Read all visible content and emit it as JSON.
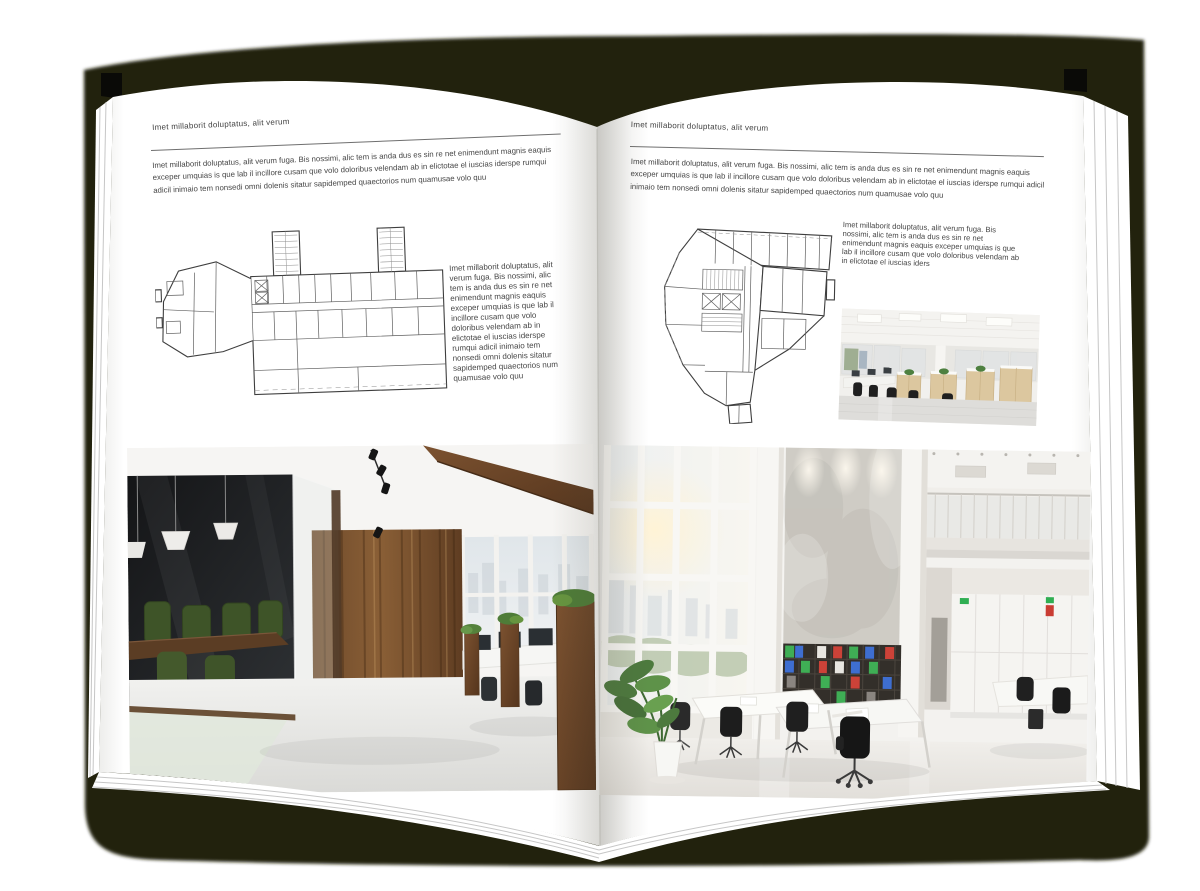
{
  "pages": {
    "left": {
      "header": "Imet millaborit doluptatus, alit verum",
      "intro": "Imet millaborit doluptatus, alit verum fuga. Bis nossimi, alic tem is anda dus es sin re net enimendunt magnis eaquis exceper umquias is que lab il incillore cusam que volo doloribus velendam ab in elictotae el iuscias iderspe rumqui adicil inimaio tem nonsedi omni dolenis sitatur sapidemped quaectorios num quamusae volo quu",
      "side_text": "Imet millaborit doluptatus, alit verum fuga. Bis nossimi, alic tem is anda dus es sin re net enimendunt magnis eaquis exceper umquias is que lab il incillore cusam que volo doloribus velendam ab in elictotae el iuscias iderspe rumqui adicil inimaio tem nonsedi omni dolenis sitatur sapidemped quaectorios num quamusae volo quu"
    },
    "right": {
      "header": "Imet millaborit doluptatus, alit verum",
      "intro": "Imet millaborit doluptatus, alit verum fuga. Bis nossimi, alic tem is anda dus es sin re net enimendunt magnis eaquis exceper umquias is que lab il incillore cusam que volo doloribus velendam ab in elictotae el iuscias iderspe rumqui adicil inimaio tem nonsedi omni dolenis sitatur sapidemped quaectorios num quamusae volo quu",
      "side_text": "Imet millaborit doluptatus, alit verum fuga. Bis nossimi, alic tem is anda dus es sin re net enimendunt magnis eaquis exceper umquias is que lab il incillore cusam que volo doloribus velendam ab in elictotae el iuscias iders"
    }
  },
  "colors": {
    "backdrop": "#20210f",
    "cover_corner": "#0a0a07",
    "page": "#ffffff",
    "text": "#474747",
    "rule": "#6f6f6f",
    "plan_lines": "#3e3e3e",
    "wood": "#6e4a2b",
    "plant_green": "#4d7a3e"
  }
}
